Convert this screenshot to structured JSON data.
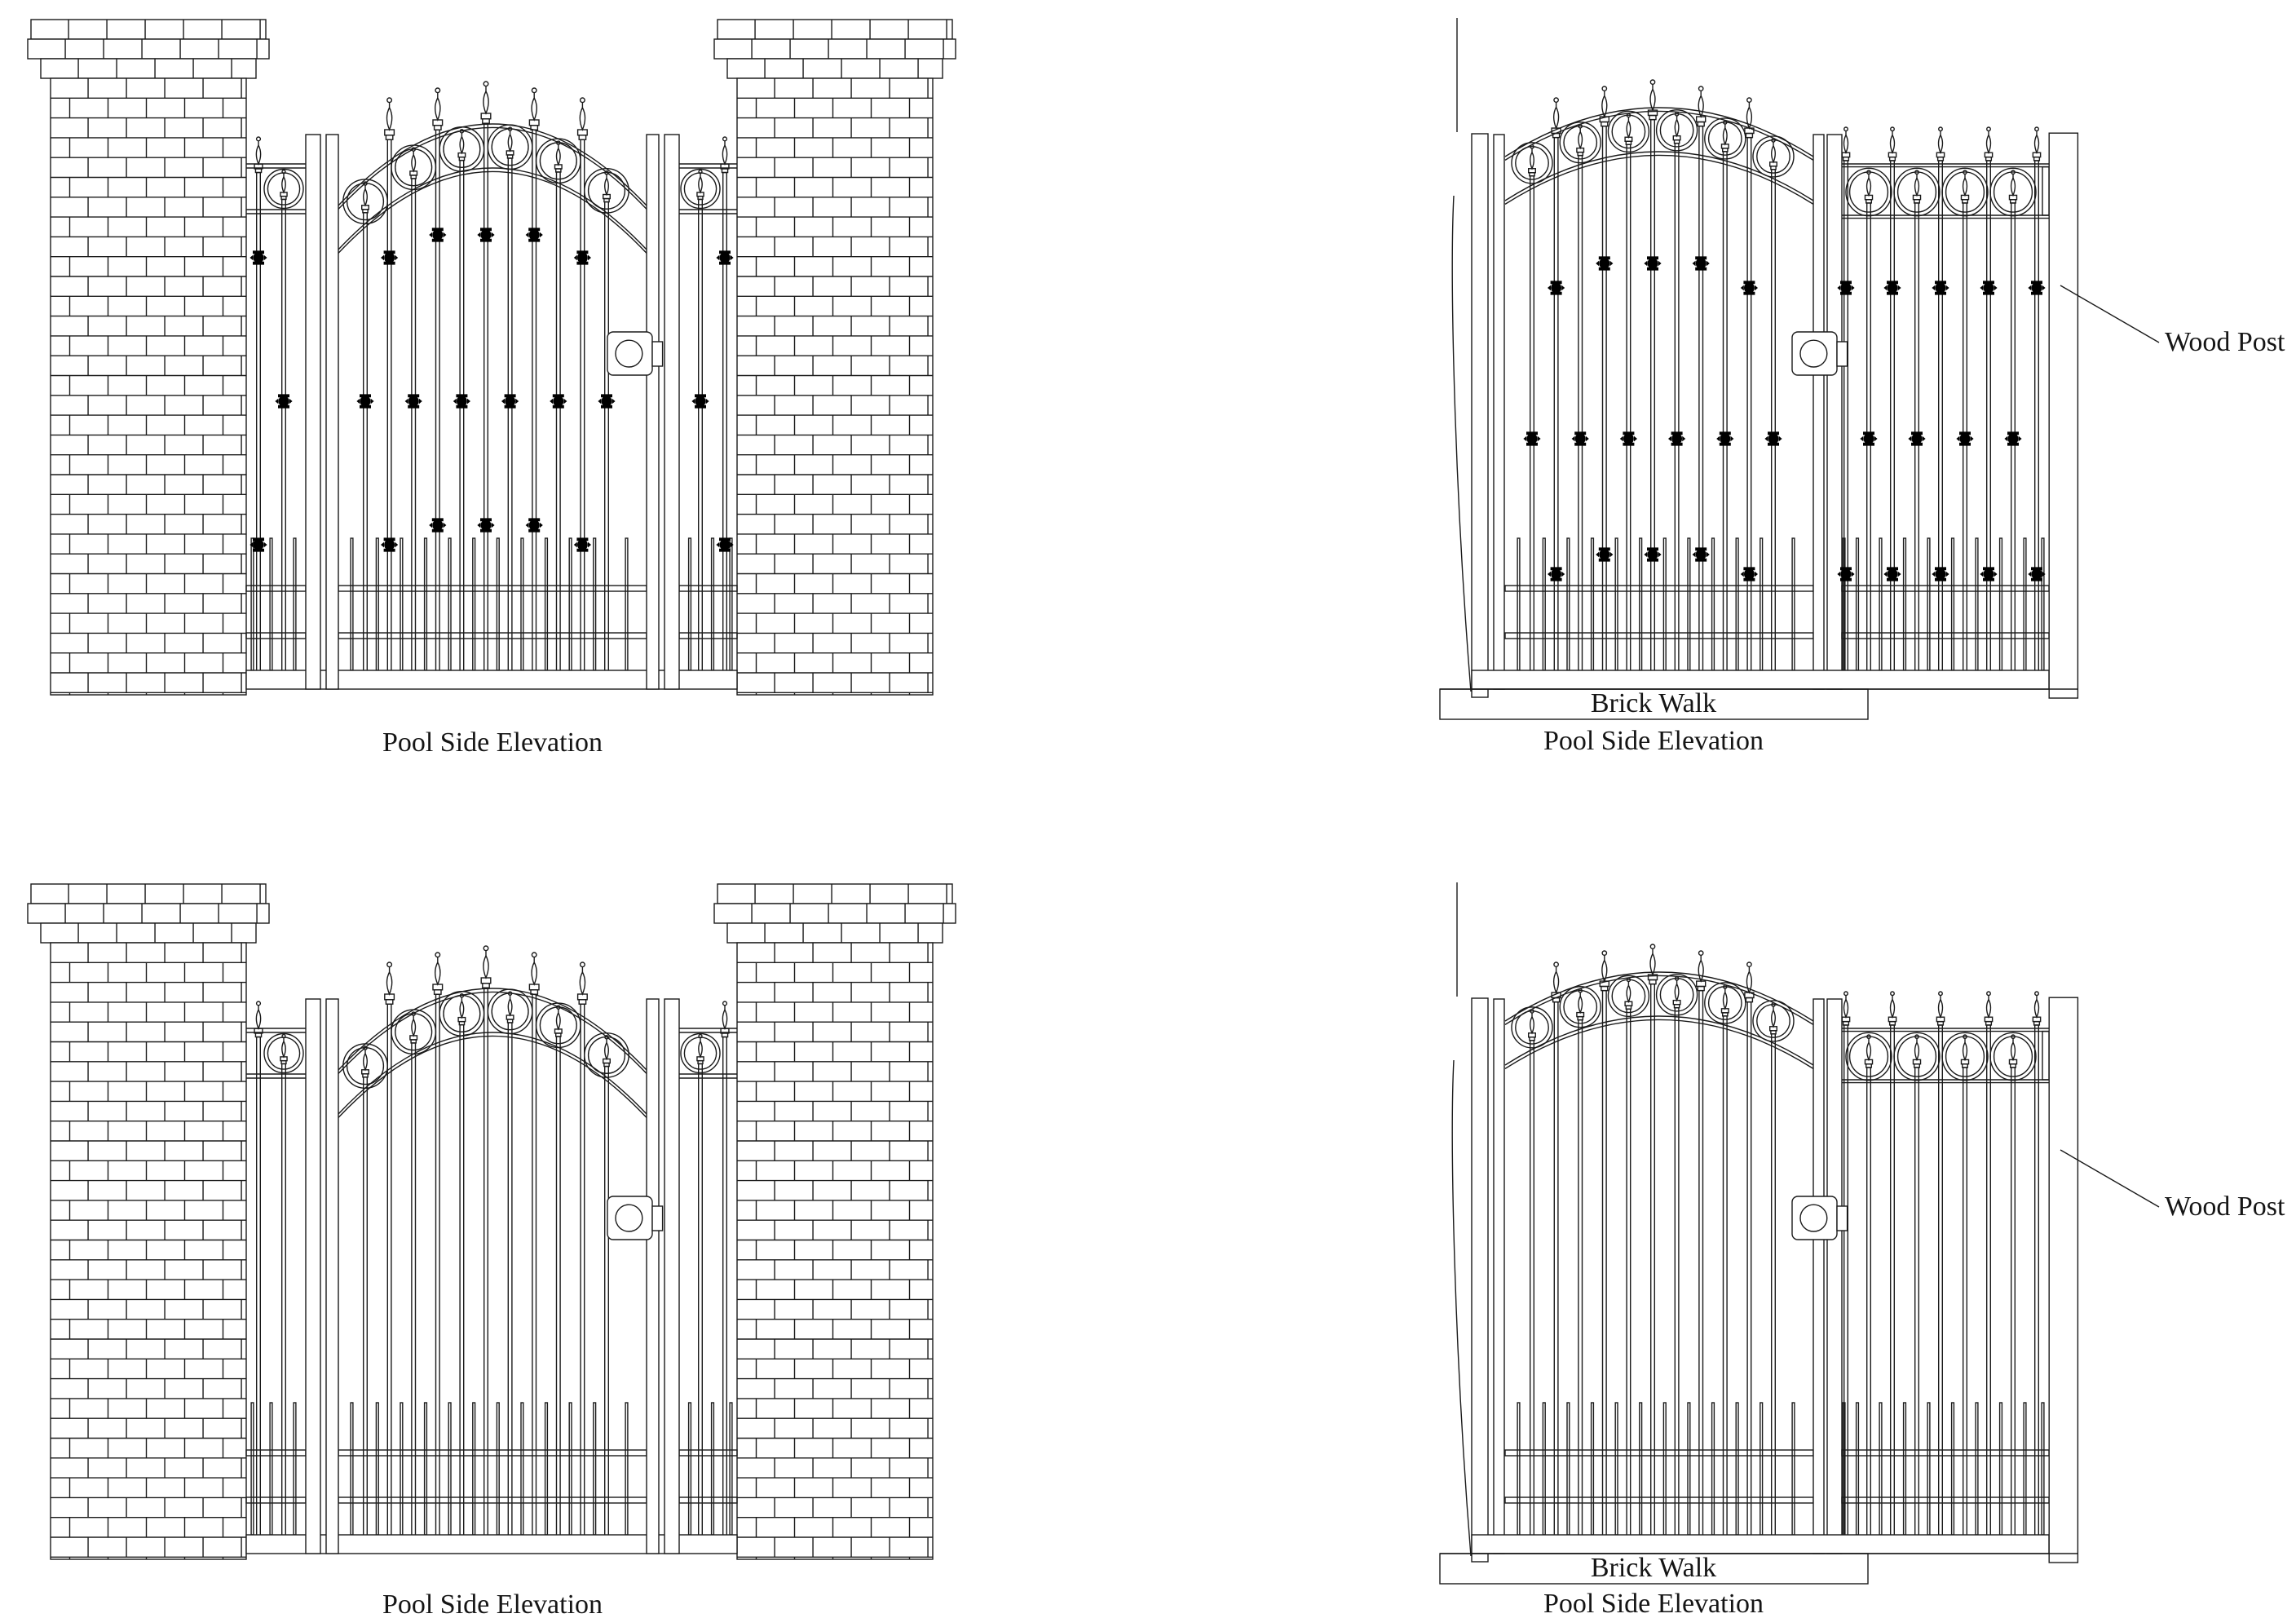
{
  "sheet": {
    "title": "Pool side gate elevations"
  },
  "panels": {
    "top_left": {
      "caption": "Pool Side Elevation"
    },
    "top_right": {
      "caption": "Pool Side Elevation",
      "walk_label": "Brick Walk",
      "post_label": "Wood Post"
    },
    "bottom_left": {
      "caption": "Pool Side Elevation"
    },
    "bottom_right": {
      "caption": "Pool Side Elevation",
      "walk_label": "Brick Walk",
      "post_label": "Wood Post"
    }
  },
  "colors": {
    "line": "#1a1a1a",
    "knuckle": "#000000",
    "background": "#ffffff"
  }
}
